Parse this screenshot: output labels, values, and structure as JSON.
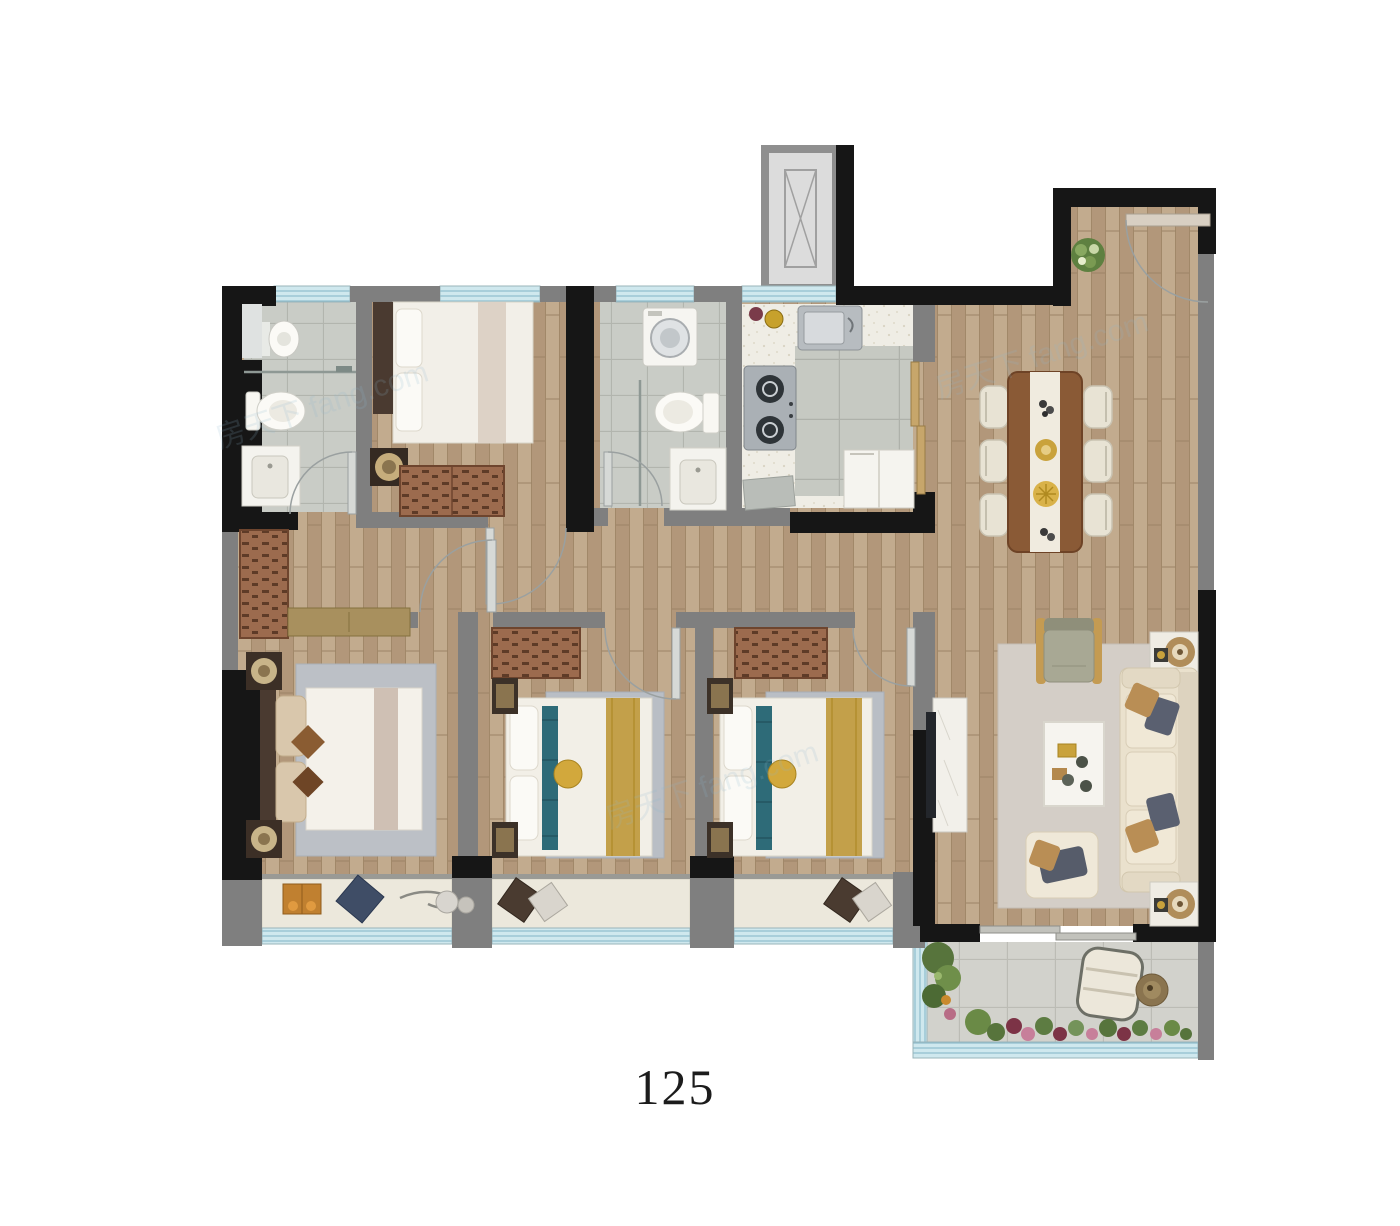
{
  "plan": {
    "area_label": "125",
    "watermark_text": "房天下 fang.com",
    "colors": {
      "wall_structural": "#161616",
      "wall_partition": "#7f7f7f",
      "window_glass": "#cfe8ee",
      "window_frame": "#8fbecd",
      "wood_floor": "#b99f82",
      "bathroom_tile": "#c9ccc6",
      "kitchen_floor": "#efede5",
      "balcony_tile": "#d2d2cc",
      "wardrobe_wood": "#9c6b4e",
      "bay_ledge": "#ece8dc",
      "sofa_cream": "#eae1cd",
      "dining_table_wood": "#8a5a36",
      "rug_living": "#d4cec7",
      "rug_bedroom": "#bcc0c6",
      "accent_gold": "#c9a23c",
      "plant_green": "#5e8040",
      "flower_pink": "#c77f9a"
    }
  }
}
